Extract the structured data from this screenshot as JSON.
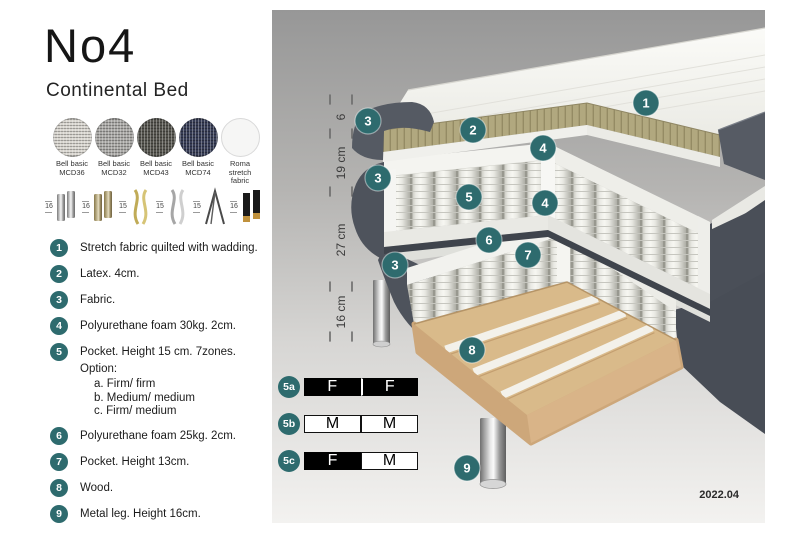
{
  "page": {
    "version_label": "2022.04"
  },
  "product": {
    "title": "No4",
    "subtitle": "Continental Bed"
  },
  "fabric_options": [
    {
      "name": "Bell basic",
      "code": "MCD36",
      "color": "#d8d5cf"
    },
    {
      "name": "Bell basic",
      "code": "MCD32",
      "color": "#a9a8a5"
    },
    {
      "name": "Bell basic",
      "code": "MCD43",
      "color": "#55544e"
    },
    {
      "name": "Bell basic",
      "code": "MCD74",
      "color": "#363c55"
    },
    {
      "name": "Roma",
      "code": "stretch fabric",
      "color": "#f6f6f5"
    }
  ],
  "leg_options": [
    {
      "height": "16",
      "type": "chrome cylinder legs"
    },
    {
      "height": "16",
      "type": "bronze cylinder legs"
    },
    {
      "height": "15",
      "type": "gold curved legs"
    },
    {
      "height": "15",
      "type": "chrome curved legs"
    },
    {
      "height": "15",
      "type": "hairpin leg"
    },
    {
      "height": "16",
      "type": "black cylinder legs"
    }
  ],
  "features": [
    {
      "num": "1",
      "text": "Stretch fabric quilted with wadding."
    },
    {
      "num": "2",
      "text": "Latex. 4cm."
    },
    {
      "num": "3",
      "text": "Fabric."
    },
    {
      "num": "4",
      "text": "Polyurethane foam 30kg. 2cm."
    },
    {
      "num": "5",
      "text": "Pocket. Height 15 cm. 7zones. Option:",
      "options": [
        "a. Firm/ firm",
        "b. Medium/ medium",
        "c. Firm/ medium"
      ]
    },
    {
      "num": "6",
      "text": "Polyurethane foam 25kg. 2cm."
    },
    {
      "num": "7",
      "text": "Pocket. Height 13cm."
    },
    {
      "num": "8",
      "text": "Wood."
    },
    {
      "num": "9",
      "text": "Metal leg. Height 16cm."
    }
  ],
  "diagram": {
    "dimensions": [
      {
        "label": "6"
      },
      {
        "label": "19 cm"
      },
      {
        "label": "27 cm"
      },
      {
        "label": "16 cm"
      }
    ],
    "callouts": [
      "1",
      "2",
      "3",
      "4",
      "3",
      "5",
      "4",
      "6",
      "7",
      "3",
      "8",
      "9"
    ]
  },
  "firmness_options": [
    {
      "label": "5a",
      "cells": [
        {
          "value": "F",
          "variant": "dark"
        },
        {
          "value": "F",
          "variant": "dark"
        }
      ]
    },
    {
      "label": "5b",
      "cells": [
        {
          "value": "M",
          "variant": "light"
        },
        {
          "value": "M",
          "variant": "light"
        }
      ]
    },
    {
      "label": "5c",
      "cells": [
        {
          "value": "F",
          "variant": "dark"
        },
        {
          "value": "M",
          "variant": "light"
        }
      ]
    }
  ],
  "colors": {
    "accent_teal": "#2e6b6e",
    "fabric_dark": "#4d525b",
    "latex_tan": "#b1a87f",
    "wood": "#d9ba8a",
    "panel_top": "#979797",
    "panel_bottom": "#f3f2f0"
  }
}
